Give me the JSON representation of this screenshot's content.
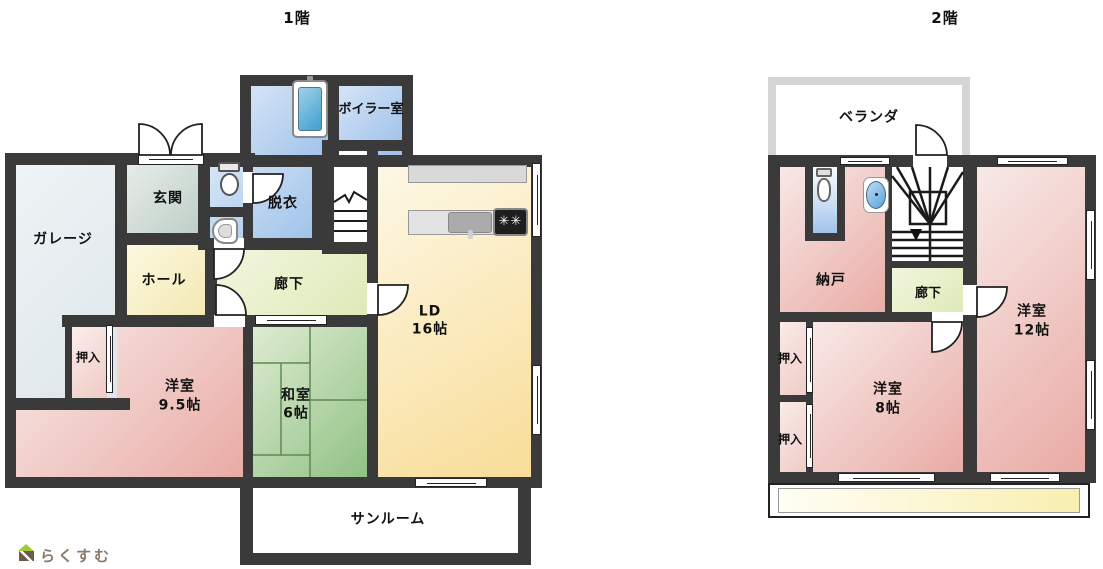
{
  "floor1": {
    "title": "1階",
    "garage": "ガレージ",
    "entrance": "玄関",
    "boiler_room": "ボイラー室",
    "dressing_room": "脱衣",
    "hall": "ホール",
    "corridor": "廊下",
    "living_dining": {
      "name": "LD",
      "size": "16帖"
    },
    "closet": "押入",
    "western_room": {
      "name": "洋室",
      "size": "9.5帖"
    },
    "japanese_room": {
      "name": "和室",
      "size": "6帖"
    },
    "sunroom": "サンルーム"
  },
  "floor2": {
    "title": "2階",
    "veranda": "ベランダ",
    "storage": "納戸",
    "corridor": "廊下",
    "western_room_12": {
      "name": "洋室",
      "size": "12帖"
    },
    "closet_upper": "押入",
    "closet_lower": "押入",
    "western_room_8": {
      "name": "洋室",
      "size": "8帖"
    }
  },
  "logo": {
    "text": "らくすむ"
  },
  "colors": {
    "wall": "#3a3a3a",
    "water_room_blue": "#97bde8",
    "pink_room": "#e9a9a3",
    "tatami_green": "#8fc083",
    "ld_cream": "#f8dc96",
    "corridor_green": "#dce9b4",
    "hall_yellow": "#f2e7ad",
    "garage_gray": "#dde6ea",
    "veranda_border": "#d5d5d5",
    "roof_strip_yellow": "#f9efb0",
    "logo_text": "#8a7968",
    "logo_roof_green": "#a3c93a",
    "logo_body_brown": "#6f5b4a"
  }
}
